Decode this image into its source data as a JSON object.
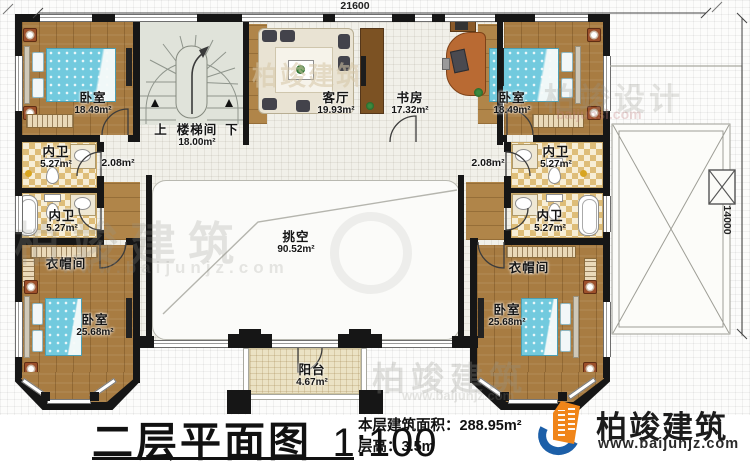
{
  "title_block": {
    "plan_title": "二层平面图",
    "scale": "1:100",
    "area_label": "本层建筑面积：",
    "area_value": "288.95m²",
    "height_label": "层高：",
    "height_value": "3.5m"
  },
  "brand": {
    "name": "柏竣建筑",
    "website": "www.baijunjz.com"
  },
  "dimensions": {
    "top_width": "21600",
    "right_height": "14000"
  },
  "stair": {
    "label": "楼梯间",
    "area": "18.00m²",
    "up": "上",
    "down": "下"
  },
  "corridors": {
    "left_area": "2.08m²",
    "right_area": "2.08m²"
  },
  "rooms": {
    "bedroom_top_left": {
      "label": "卧室",
      "area": "18.49m²"
    },
    "living": {
      "label": "客厅",
      "area": "19.93m²"
    },
    "study": {
      "label": "书房",
      "area": "17.32m²"
    },
    "bedroom_top_right": {
      "label": "卧室",
      "area": "18.49m²"
    },
    "bath_left_upper": {
      "label": "内卫",
      "area": "5.27m²"
    },
    "bath_left_lower": {
      "label": "内卫",
      "area": "5.27m²"
    },
    "bath_right_upper": {
      "label": "内卫",
      "area": "5.27m²"
    },
    "bath_right_lower": {
      "label": "内卫",
      "area": "5.27m²"
    },
    "closet_left": {
      "label": "衣帽间"
    },
    "closet_right": {
      "label": "衣帽间"
    },
    "bedroom_bottom_left": {
      "label": "卧室",
      "area": "25.68m²"
    },
    "bedroom_bottom_right": {
      "label": "卧室",
      "area": "25.68m²"
    },
    "void": {
      "label": "挑空",
      "area": "90.52m²"
    },
    "balcony": {
      "label": "阳台",
      "area": "4.67m²"
    }
  },
  "watermarks": {
    "brand": "柏竣建筑",
    "brand_url": "www.baijunjz.com",
    "design": "柏竣设计",
    "design_url": "baijunsi.com"
  },
  "colors": {
    "wall": "#161616",
    "wood_floor": "#a87c42",
    "bath_tile": "#debd78",
    "bed": "#72cade",
    "stair": "#e0e3da",
    "balcony_tile": "#ebe2c4",
    "logo_blue": "#1c5fa8",
    "logo_orange": "#f08519"
  }
}
